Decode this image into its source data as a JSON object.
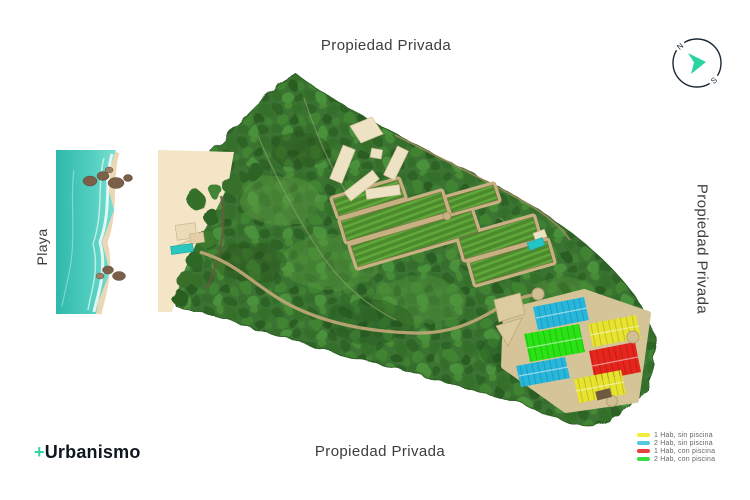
{
  "labels": {
    "top": "Propiedad Privada",
    "bottom": "Propiedad Privada",
    "right": "Propiedad Privada",
    "left": "Playa"
  },
  "compass": {
    "north": "N",
    "south": "S"
  },
  "logo": {
    "plus": "+",
    "name": "Urbanismo"
  },
  "legend": {
    "items": [
      {
        "label": "1 Hab, sin piscina",
        "color": "#f0ed3c",
        "swatch_style": "background:#f0ed3c"
      },
      {
        "label": "2 Hab, sin piscina",
        "color": "#57c6e0",
        "swatch_style": "background:#57c6e0"
      },
      {
        "label": "1 Hab, con piscina",
        "color": "#e8403a",
        "swatch_style": "background:#e8403a"
      },
      {
        "label": "2 Hab, con piscina",
        "color": "#3cdc43",
        "swatch_style": "background:#3cdc43"
      }
    ]
  },
  "map": {
    "lot_colors": {
      "blue": "#28b7dc",
      "yellow": "#e7e32f",
      "red": "#e6251c",
      "green": "#2ae315"
    },
    "accent_teal": "#2fd3a4",
    "forest_green": "#3a7330",
    "water_teal": "#45c7b8",
    "sand": "#f3e5c6",
    "road_tan": "#bda575"
  }
}
